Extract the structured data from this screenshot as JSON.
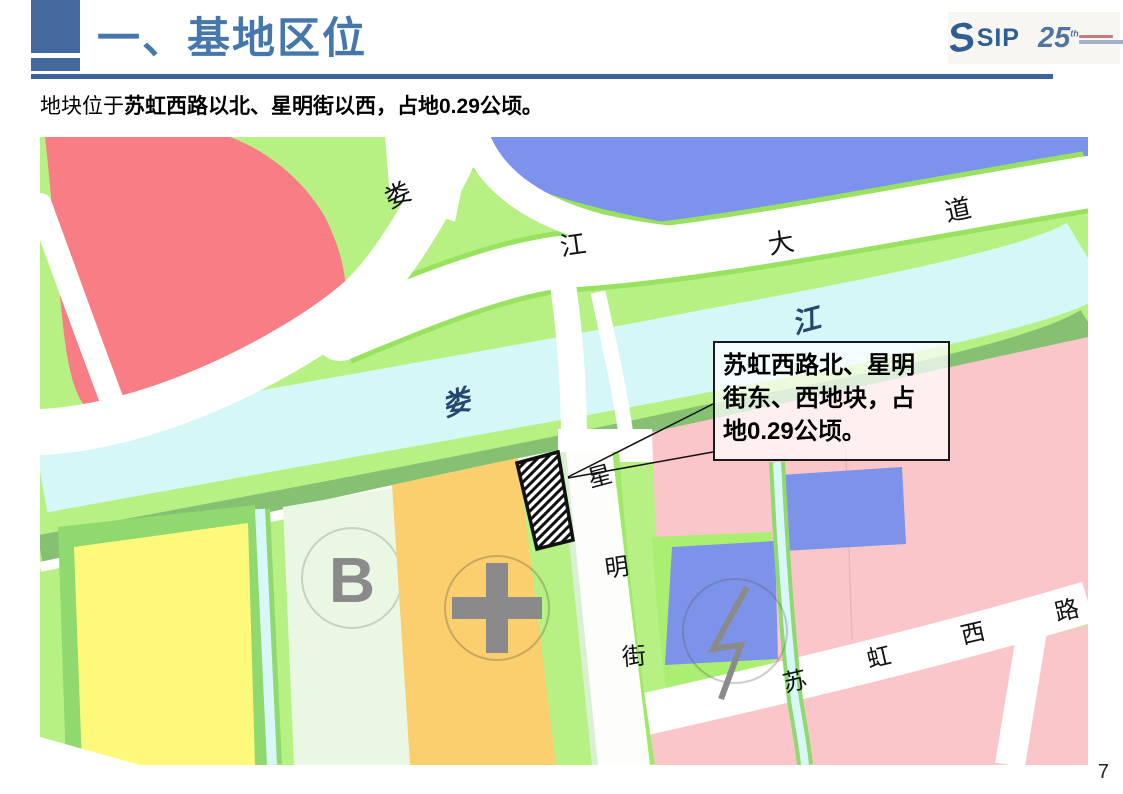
{
  "page": {
    "number": "7"
  },
  "header": {
    "title": "一、基地区位",
    "logo": {
      "brand": "SIP",
      "anniversary": "25",
      "anniversary_suffix": "th"
    }
  },
  "subtitle": {
    "prefix": "地块位于",
    "emphasis": "苏虹西路以北、星明街以西，占地0.29公顷。"
  },
  "map": {
    "labels": {
      "loujiang_avenue": [
        "娄",
        "江",
        "大",
        "道"
      ],
      "loujiang_river": [
        "娄",
        "江"
      ],
      "xingming_street": [
        "星",
        "明",
        "街"
      ],
      "suhong_west_road": [
        "苏",
        "虹",
        "西",
        "路"
      ],
      "block_b": "B"
    },
    "callout": {
      "text": "苏虹西路北、星明街东、西地块，占地0.29公顷。",
      "lines": [
        "苏虹西路北、星明",
        "街东、西地块，占",
        "地0.29公顷。"
      ]
    },
    "icons": {
      "lightning": "substation-lightning-icon",
      "cross": "cross-landmark-icon",
      "hatch": "site-hatch-marker"
    },
    "palette": {
      "accent_blue": "#44699e",
      "title_blue": "#4677ac",
      "base_green": "#b7f183",
      "water_blue": "#7d92ec",
      "river_cyan": "#d6f7f8",
      "bank_green": "#85c073",
      "residential_red": "#f87d85",
      "parcel_yellow": "#fcf97b",
      "parcel_orange": "#fbcf6e",
      "parcel_pale_green": "#eaf7e3",
      "block_pink": "#fbc6c9",
      "block_blue": "#7d93ea",
      "symbol_gray": "#8a8a8a"
    }
  }
}
